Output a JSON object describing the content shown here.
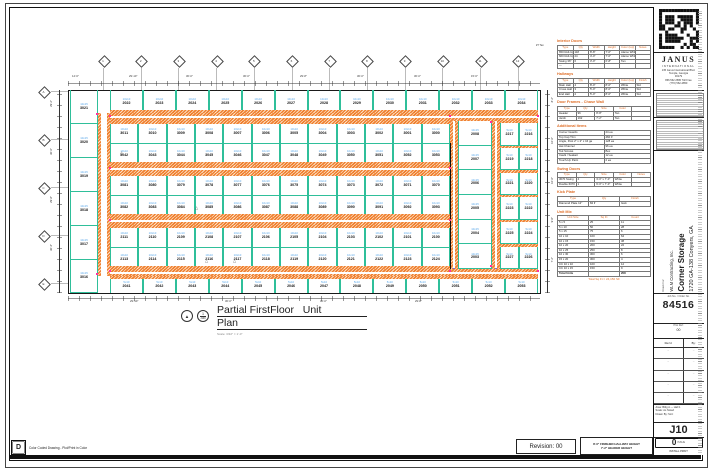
{
  "colors": {
    "teal": "#2fbf9a",
    "orange": "#f08030",
    "unit_size_blue": "#5aa7e8",
    "magenta": "#ff2fa0",
    "purple": "#7a6ad8",
    "notes_orange": "#e0702a"
  },
  "plan_title": {
    "line1": "Partial FirstFloor   Unit",
    "line2": "Plan",
    "scale": "Scale: 3/32\" = 1'-0\"",
    "detail_top": "1",
    "detail_bottom": "J100"
  },
  "plan": {
    "grid_top": [
      "1",
      "2",
      "3",
      "4",
      "5",
      "6",
      "7",
      "8",
      "9",
      "10",
      "11",
      "12"
    ],
    "grid_left": [
      "A",
      "B",
      "C",
      "D",
      "E"
    ],
    "dims_top": [
      "14'-6\"",
      "29'-10\"",
      "30'-0\"",
      "30'-0\"",
      "29'-8\"",
      "30'-0\"",
      "30'-0\"",
      "15'-6\""
    ],
    "dims_bottom": [
      "29'-10\"",
      "30'-0\"",
      "30'-0\"",
      "29'-8\""
    ],
    "dims_left": [
      "29'-2\"",
      "30'-0\"",
      "29'-8\"",
      "30'-4\""
    ],
    "dims_right": [
      "8'-2\"",
      "10'-0\"",
      "10'-0\"",
      "9'-6\"",
      "7'-2\""
    ],
    "left_strip": {
      "size": "10x15",
      "numbers": [
        "3021",
        "3020",
        "3019",
        "3018",
        "3017",
        "3016"
      ]
    },
    "rows": [
      {
        "size": "10x10",
        "numbers": [
          "2022",
          "2023",
          "2024",
          "2025",
          "2026",
          "2027",
          "2028",
          "2029",
          "2030",
          "2031",
          "2032",
          "2033",
          "2034"
        ]
      },
      {
        "size": "10x10",
        "numbers": [
          "3011",
          "3010",
          "3009",
          "3008",
          "3007",
          "3006",
          "3005",
          "3004",
          "3003",
          "3002",
          "3001",
          "3000"
        ]
      },
      {
        "size": "10x10",
        "numbers": [
          "3042",
          "3043",
          "3044",
          "3045",
          "3046",
          "3047",
          "3048",
          "3049",
          "3050",
          "3051",
          "3052",
          "3053"
        ]
      },
      {
        "size": "10x10",
        "numbers": [
          "3081",
          "3080",
          "3079",
          "3078",
          "3077",
          "3076",
          "3075",
          "3074",
          "3073",
          "3072",
          "3071",
          "3070"
        ]
      },
      {
        "size": "10x10",
        "numbers": [
          "3082",
          "3083",
          "3084",
          "3085",
          "3086",
          "3087",
          "3088",
          "3089",
          "3090",
          "3091",
          "3092",
          "3093"
        ]
      },
      {
        "size": "10x10",
        "numbers": [
          "2111",
          "2110",
          "2109",
          "2108",
          "2107",
          "2106",
          "2105",
          "2104",
          "2103",
          "2102",
          "2101",
          "2100"
        ]
      },
      {
        "size": "10x10",
        "numbers": [
          "2113",
          "2114",
          "2115",
          "2116",
          "2117",
          "2118",
          "2119",
          "2120",
          "2121",
          "2122",
          "2123",
          "2124"
        ]
      },
      {
        "size": "5x10",
        "numbers": [
          "2041",
          "2042",
          "2043",
          "2044",
          "2045",
          "2046",
          "2047",
          "2048",
          "2049",
          "2050",
          "2051",
          "2052",
          "2053"
        ]
      }
    ],
    "right_single": {
      "size": "10x15",
      "numbers": [
        "2008",
        "2007",
        "2006",
        "2005",
        "2004",
        "2003"
      ]
    },
    "right_pairs": {
      "size": "5x10",
      "pairs": [
        [
          "2217",
          "2216"
        ],
        [
          "2219",
          "2218"
        ],
        [
          "2221",
          "2220"
        ],
        [
          "2223",
          "2222"
        ],
        [
          "2225",
          "2224"
        ],
        [
          "2227",
          "2226"
        ]
      ]
    }
  },
  "notes": {
    "callout": "#7 Tan",
    "sections": [
      {
        "title": "Interior Doors",
        "headers": [
          "Type",
          "Qty",
          "Width",
          "Height",
          "Color (top)",
          "Notes"
        ],
        "rows": [
          [
            "650 Roll-Up",
            "118",
            "8'-8\"",
            "7'-0\"",
            "Alamo White",
            ""
          ],
          [
            "660 Roll-Up",
            "24",
            "4'-0\"",
            "7'-0\"",
            "Alamo White",
            ""
          ],
          [
            "Swing 36\"",
            "6",
            "3'-0\"",
            "6'-8\"",
            "Tan",
            ""
          ],
          [
            "—",
            "",
            "",
            "",
            "",
            ""
          ]
        ]
      },
      {
        "title": "Hallways",
        "headers": [
          "Type",
          "Qty",
          "Width",
          "Height",
          "Color (top)",
          "Finish"
        ],
        "rows": [
          [
            "Main Hall",
            "4",
            "8'-0\"",
            "8'-0\"",
            "White",
            "Std"
          ],
          [
            "Cross Hall",
            "3",
            "5'-0\"",
            "8'-0\"",
            "White",
            "Std"
          ],
          [
            "End Hall",
            "2",
            "5'-0\"",
            "8'-0\"",
            "White",
            "Std"
          ]
        ]
      },
      {
        "title": "Door Frames - Chase Wall",
        "headers": [
          "Type",
          "Qty",
          "Size",
          "Color",
          ""
        ],
        "rows": [
          [
            "Header",
            "96",
            "8'-8\"",
            "Tan",
            ""
          ],
          [
            "Jamb",
            "192",
            "7'-2\"",
            "Tan",
            ""
          ]
        ]
      },
      {
        "title": "Additional Items",
        "list": [
          [
            "Corner Guards",
            "24 ea"
          ],
          [
            "Top Cap Trim",
            "460 lf"
          ],
          [
            "Angle, Post 2\" x 2\" x 16 ga",
            "128 ea"
          ],
          [
            "Hat Channel",
            "96 ea"
          ],
          [
            "Tek Screws",
            "Box"
          ],
          [
            "Caulk / Sealant",
            "12 ea"
          ],
          [
            "Touch-Up Paint",
            "2 ea"
          ]
        ]
      },
      {
        "title": "Swing Doors",
        "headers": [
          "Type",
          "Qty",
          "Size",
          "Color",
          "Notes"
        ],
        "rows": [
          [
            "3070 Swing",
            "4",
            "3'-0\" x 7'-0\"",
            "White",
            ""
          ],
          [
            "Double 6070",
            "1",
            "6'-0\" x 7'-0\"",
            "White",
            ""
          ]
        ]
      },
      {
        "title": "Kick Plate",
        "headers": [
          "Type",
          "Qty",
          "Finish"
        ],
        "rows": [
          [
            "Diamond Plate 12\"",
            "84 lf",
            "Galv"
          ]
        ]
      },
      {
        "title": "Unit Mix",
        "headers": [
          "Unit Size",
          "Sq Ft",
          "Count"
        ],
        "rows": [
          [
            "5 x 5",
            "25",
            "11"
          ],
          [
            "5 x 10",
            "50",
            "28"
          ],
          [
            "5 x 15",
            "75",
            "6"
          ],
          [
            "10 x 10",
            "100",
            "64"
          ],
          [
            "10 x 15",
            "150",
            "38"
          ],
          [
            "10 x 20",
            "200",
            "22"
          ],
          [
            "10 x 25",
            "250",
            "8"
          ],
          [
            "10 x 30",
            "300",
            "6"
          ],
          [
            "15 x 20",
            "300",
            "4"
          ],
          [
            "CC 10 x 10",
            "100",
            "12"
          ],
          [
            "CC 10 x 15",
            "150",
            "9"
          ]
        ],
        "total_row": [
          "Total Units",
          "",
          "208"
        ],
        "footer": "Total Sq Ft = 24,150 SF"
      }
    ]
  },
  "titleblock": {
    "brand_name": "JANUS",
    "brand_sub": "INTERNATIONAL",
    "brand_addr": [
      "135 Janus International Blvd.",
      "Temple, Georgia",
      "30179",
      "866.562.2580 Toll Free",
      "(770) 562-2850"
    ],
    "drawn_for_label": "Drawn For:",
    "client": "WLM Contracting, Inc.",
    "project": "Corner Storage",
    "address": "1720 GA-138 Conyers, GA.",
    "job_label": "Job No. / Order No.",
    "job_no": "84516",
    "plot_label": "Plot Ref:",
    "plot_val": "00",
    "rev_head_l": "Rev'd",
    "rev_head_r": "By:",
    "rev_rows": [
      "–",
      "–",
      "–",
      "–",
      "–"
    ],
    "info_lines": [
      "Area: Bldg A — Hall 1",
      "Scale: As Noted",
      "Drawn By: SLC"
    ],
    "sheet_no": "J10",
    "issue_no": "0",
    "issue_label": "ISSUE",
    "print_label": "INSTALL PRINT"
  },
  "footer": {
    "legend_key": "D",
    "legend_text": "Color Coded Drawing - Plot/Print in Color",
    "revision": "Revision: 00",
    "note_line1": "8'-0\" FINISHED HALLWAY HEIGHT",
    "note_line2": "7'-2\" HEADER HEIGHT"
  }
}
